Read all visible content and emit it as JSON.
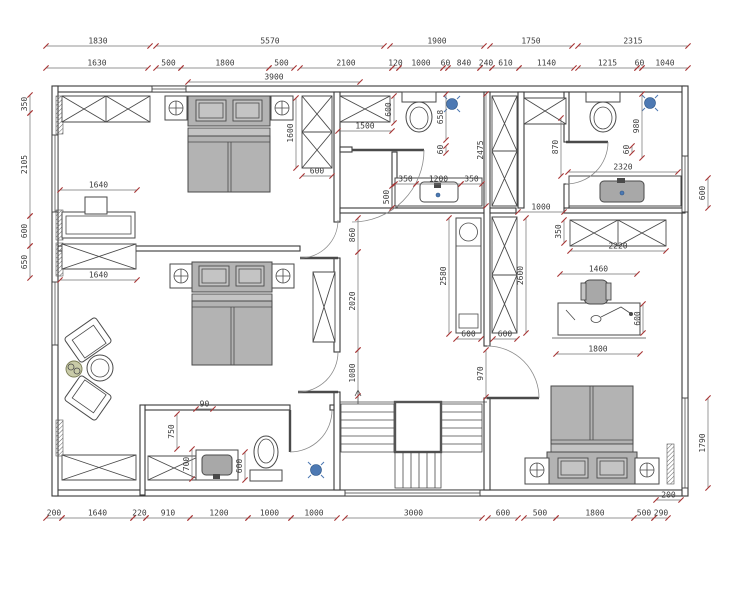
{
  "meta": {
    "title": "residential-floor-plan"
  },
  "palette": {
    "paper": "#ffffff",
    "line": "#3a3a3a",
    "dim_text": "#3b3b3b",
    "tick": "#a83434",
    "furniture_fill": "#b3b3b3",
    "fixture_blue": "#4d79b3",
    "plant_green": "#c9cba8"
  },
  "dimensions": [
    {
      "t": "1830",
      "x1": 46,
      "y1": 46,
      "x2": 150,
      "y2": 46
    },
    {
      "t": "5570",
      "x1": 156,
      "y1": 46,
      "x2": 384,
      "y2": 46
    },
    {
      "t": "1900",
      "x1": 390,
      "y1": 46,
      "x2": 484,
      "y2": 46
    },
    {
      "t": "1750",
      "x1": 490,
      "y1": 46,
      "x2": 572,
      "y2": 46
    },
    {
      "t": "2315",
      "x1": 578,
      "y1": 46,
      "x2": 688,
      "y2": 46
    },
    {
      "t": "1630",
      "x1": 46,
      "y1": 68,
      "x2": 148,
      "y2": 68
    },
    {
      "t": "500",
      "x1": 156,
      "y1": 68,
      "x2": 181,
      "y2": 68
    },
    {
      "t": "1800",
      "x1": 181,
      "y1": 68,
      "x2": 269,
      "y2": 68
    },
    {
      "t": "500",
      "x1": 269,
      "y1": 68,
      "x2": 294,
      "y2": 68
    },
    {
      "t": "2100",
      "x1": 300,
      "y1": 68,
      "x2": 392,
      "y2": 68
    },
    {
      "t": "120",
      "x1": 392,
      "y1": 68,
      "x2": 399,
      "y2": 68
    },
    {
      "t": "1000",
      "x1": 399,
      "y1": 68,
      "x2": 443,
      "y2": 68
    },
    {
      "t": "60",
      "x1": 443,
      "y1": 68,
      "x2": 448,
      "y2": 68
    },
    {
      "t": "840",
      "x1": 448,
      "y1": 68,
      "x2": 480,
      "y2": 68
    },
    {
      "t": "240",
      "x1": 480,
      "y1": 68,
      "x2": 492,
      "y2": 68
    },
    {
      "t": "610",
      "x1": 492,
      "y1": 68,
      "x2": 519,
      "y2": 68
    },
    {
      "t": "1140",
      "x1": 519,
      "y1": 68,
      "x2": 574,
      "y2": 68
    },
    {
      "t": "1215",
      "x1": 578,
      "y1": 68,
      "x2": 637,
      "y2": 68
    },
    {
      "t": "60",
      "x1": 637,
      "y1": 68,
      "x2": 642,
      "y2": 68
    },
    {
      "t": "1040",
      "x1": 642,
      "y1": 68,
      "x2": 688,
      "y2": 68
    },
    {
      "t": "3900",
      "x1": 188,
      "y1": 82,
      "x2": 360,
      "y2": 82
    },
    {
      "t": "350",
      "x1": 30,
      "y1": 95,
      "x2": 30,
      "y2": 113
    },
    {
      "t": "2105",
      "x1": 30,
      "y1": 113,
      "x2": 30,
      "y2": 216
    },
    {
      "t": "600",
      "x1": 30,
      "y1": 216,
      "x2": 30,
      "y2": 246
    },
    {
      "t": "650",
      "x1": 30,
      "y1": 246,
      "x2": 30,
      "y2": 278
    },
    {
      "t": "600",
      "x1": 708,
      "y1": 178,
      "x2": 708,
      "y2": 208
    },
    {
      "t": "1790",
      "x1": 708,
      "y1": 398,
      "x2": 708,
      "y2": 488
    },
    {
      "t": "200",
      "x1": 46,
      "y1": 518,
      "x2": 62,
      "y2": 518
    },
    {
      "t": "1640",
      "x1": 62,
      "y1": 518,
      "x2": 133,
      "y2": 518
    },
    {
      "t": "220",
      "x1": 133,
      "y1": 518,
      "x2": 146,
      "y2": 518
    },
    {
      "t": "910",
      "x1": 146,
      "y1": 518,
      "x2": 190,
      "y2": 518
    },
    {
      "t": "1200",
      "x1": 190,
      "y1": 518,
      "x2": 248,
      "y2": 518
    },
    {
      "t": "1000",
      "x1": 248,
      "y1": 518,
      "x2": 291,
      "y2": 518
    },
    {
      "t": "1000",
      "x1": 291,
      "y1": 518,
      "x2": 337,
      "y2": 518
    },
    {
      "t": "3000",
      "x1": 345,
      "y1": 518,
      "x2": 482,
      "y2": 518
    },
    {
      "t": "600",
      "x1": 488,
      "y1": 518,
      "x2": 518,
      "y2": 518
    },
    {
      "t": "500",
      "x1": 524,
      "y1": 518,
      "x2": 556,
      "y2": 518
    },
    {
      "t": "1800",
      "x1": 556,
      "y1": 518,
      "x2": 634,
      "y2": 518
    },
    {
      "t": "500",
      "x1": 634,
      "y1": 518,
      "x2": 654,
      "y2": 518
    },
    {
      "t": "290",
      "x1": 654,
      "y1": 518,
      "x2": 668,
      "y2": 518
    },
    {
      "t": "1600",
      "x1": 296,
      "y1": 98,
      "x2": 296,
      "y2": 168
    },
    {
      "t": "600",
      "x1": 302,
      "y1": 176,
      "x2": 332,
      "y2": 176
    },
    {
      "t": "1500",
      "x1": 338,
      "y1": 131,
      "x2": 392,
      "y2": 131
    },
    {
      "t": "600",
      "x1": 394,
      "y1": 96,
      "x2": 394,
      "y2": 123
    },
    {
      "t": "658",
      "x1": 446,
      "y1": 94,
      "x2": 446,
      "y2": 140
    },
    {
      "t": "60",
      "x1": 446,
      "y1": 146,
      "x2": 446,
      "y2": 153
    },
    {
      "t": "2475",
      "x1": 486,
      "y1": 94,
      "x2": 486,
      "y2": 206
    },
    {
      "t": "350",
      "x1": 395,
      "y1": 184,
      "x2": 416,
      "y2": 184
    },
    {
      "t": "1200",
      "x1": 416,
      "y1": 184,
      "x2": 461,
      "y2": 184
    },
    {
      "t": "350",
      "x1": 461,
      "y1": 184,
      "x2": 482,
      "y2": 184
    },
    {
      "t": "500",
      "x1": 392,
      "y1": 186,
      "x2": 392,
      "y2": 208
    },
    {
      "t": "980",
      "x1": 642,
      "y1": 94,
      "x2": 642,
      "y2": 158
    },
    {
      "t": "60",
      "x1": 632,
      "y1": 146,
      "x2": 632,
      "y2": 153
    },
    {
      "t": "870",
      "x1": 561,
      "y1": 118,
      "x2": 561,
      "y2": 176
    },
    {
      "t": "2320",
      "x1": 568,
      "y1": 172,
      "x2": 678,
      "y2": 172
    },
    {
      "t": "1000",
      "x1": 518,
      "y1": 212,
      "x2": 564,
      "y2": 212
    },
    {
      "t": "350",
      "x1": 564,
      "y1": 220,
      "x2": 564,
      "y2": 243
    },
    {
      "t": "2220",
      "x1": 570,
      "y1": 251,
      "x2": 666,
      "y2": 251
    },
    {
      "t": "1640",
      "x1": 60,
      "y1": 190,
      "x2": 137,
      "y2": 190
    },
    {
      "t": "1640",
      "x1": 60,
      "y1": 280,
      "x2": 137,
      "y2": 280
    },
    {
      "t": "860",
      "x1": 358,
      "y1": 218,
      "x2": 358,
      "y2": 252
    },
    {
      "t": "2020",
      "x1": 358,
      "y1": 252,
      "x2": 358,
      "y2": 350
    },
    {
      "t": "1080",
      "x1": 358,
      "y1": 350,
      "x2": 358,
      "y2": 396
    },
    {
      "t": "2580",
      "x1": 449,
      "y1": 218,
      "x2": 449,
      "y2": 334
    },
    {
      "t": "600",
      "x1": 456,
      "y1": 339,
      "x2": 481,
      "y2": 339
    },
    {
      "t": "2600",
      "x1": 526,
      "y1": 218,
      "x2": 526,
      "y2": 333
    },
    {
      "t": "600",
      "x1": 493,
      "y1": 339,
      "x2": 517,
      "y2": 339
    },
    {
      "t": "970",
      "x1": 486,
      "y1": 350,
      "x2": 486,
      "y2": 397
    },
    {
      "t": "1460",
      "x1": 560,
      "y1": 274,
      "x2": 637,
      "y2": 274
    },
    {
      "t": "600",
      "x1": 643,
      "y1": 304,
      "x2": 643,
      "y2": 333
    },
    {
      "t": "1800",
      "x1": 556,
      "y1": 354,
      "x2": 640,
      "y2": 354
    },
    {
      "t": "750",
      "x1": 177,
      "y1": 414,
      "x2": 177,
      "y2": 449
    },
    {
      "t": "700",
      "x1": 192,
      "y1": 449,
      "x2": 192,
      "y2": 479
    },
    {
      "t": "600",
      "x1": 245,
      "y1": 452,
      "x2": 245,
      "y2": 480
    },
    {
      "t": "90",
      "x1": 196,
      "y1": 409,
      "x2": 213,
      "y2": 409
    },
    {
      "t": "200",
      "x1": 656,
      "y1": 500,
      "x2": 681,
      "y2": 500
    }
  ]
}
